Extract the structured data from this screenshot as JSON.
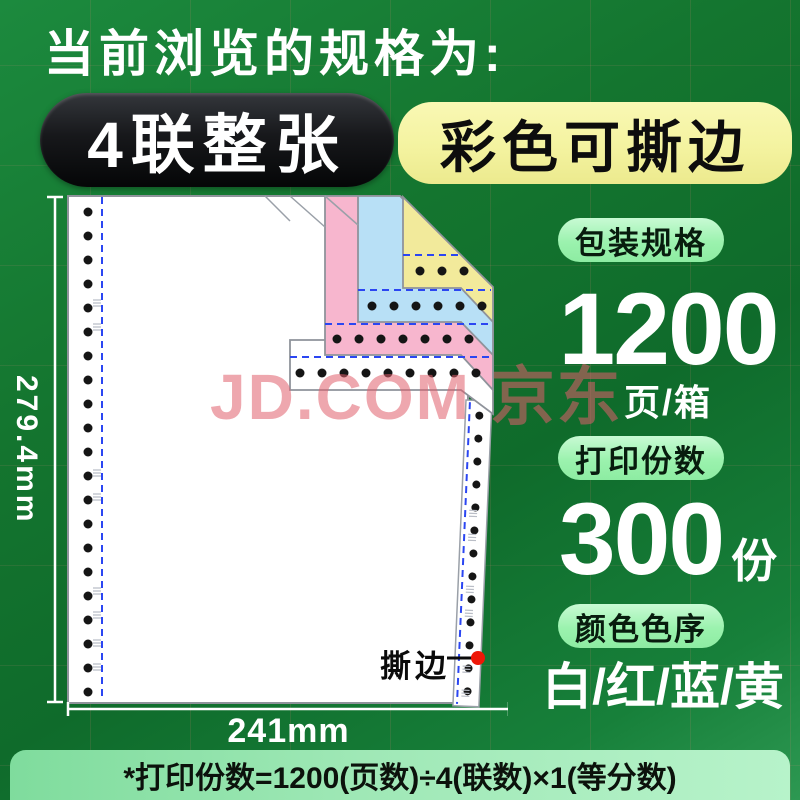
{
  "header": {
    "title": "当前浏览的规格为:",
    "badge_primary": "4联整张",
    "badge_secondary": "彩色可撕边"
  },
  "diagram": {
    "height_label": "279.4mm",
    "width_label": "241mm",
    "tear_label": "撕边",
    "watermark": "JD.COM 京东"
  },
  "specs": [
    {
      "label": "包装规格",
      "value": "1200",
      "unit": "页/箱"
    },
    {
      "label": "打印份数",
      "value": "300",
      "unit": "份"
    },
    {
      "label": "颜色色序",
      "value": "白/红/蓝/黄",
      "unit": ""
    }
  ],
  "footnote": "*打印份数=1200(页数)÷4(联数)×1(等分数)",
  "colors": {
    "sheet_white": "#ffffff",
    "ply_red": "#f7b6ce",
    "ply_blue": "#b8e0f6",
    "ply_yellow": "#f2ea9b",
    "sheet_edge_gray": "#8f939b",
    "perforation_blue": "#2b46f2",
    "tear_marker_red": "#ee1707",
    "hole_black": "#151515",
    "dimension_white": "#ffffff"
  }
}
